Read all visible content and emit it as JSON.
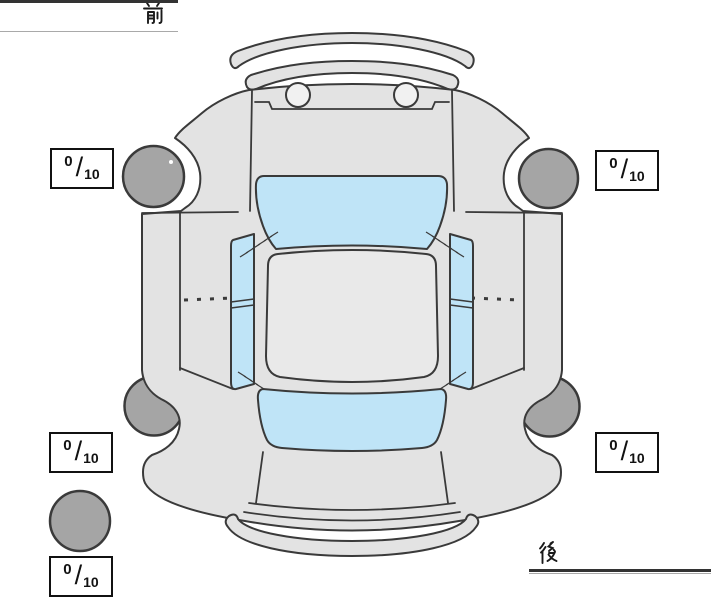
{
  "diagram": {
    "orientation": {
      "front_label": "前",
      "rear_label": "後"
    },
    "separator": "/",
    "tread_depth_scores": {
      "front_left": {
        "value": "0",
        "max": "10"
      },
      "front_right": {
        "value": "0",
        "max": "10"
      },
      "rear_left": {
        "value": "0",
        "max": "10"
      },
      "rear_right": {
        "value": "0",
        "max": "10"
      },
      "spare": {
        "value": "0",
        "max": "10"
      }
    }
  },
  "colors": {
    "bg": "#ffffff",
    "outline": "#3a3a3a",
    "body": "#e3e3e3",
    "body_light": "#e9e9e9",
    "window": "#bfe4f7",
    "wheel": "#a5a5a5",
    "nozzle": "#f1f1f1",
    "box_border": "#111111",
    "text": "#111111",
    "line": "#333333",
    "line_shadow": "#a9a9a9",
    "kanji": "#1a1a1a"
  }
}
